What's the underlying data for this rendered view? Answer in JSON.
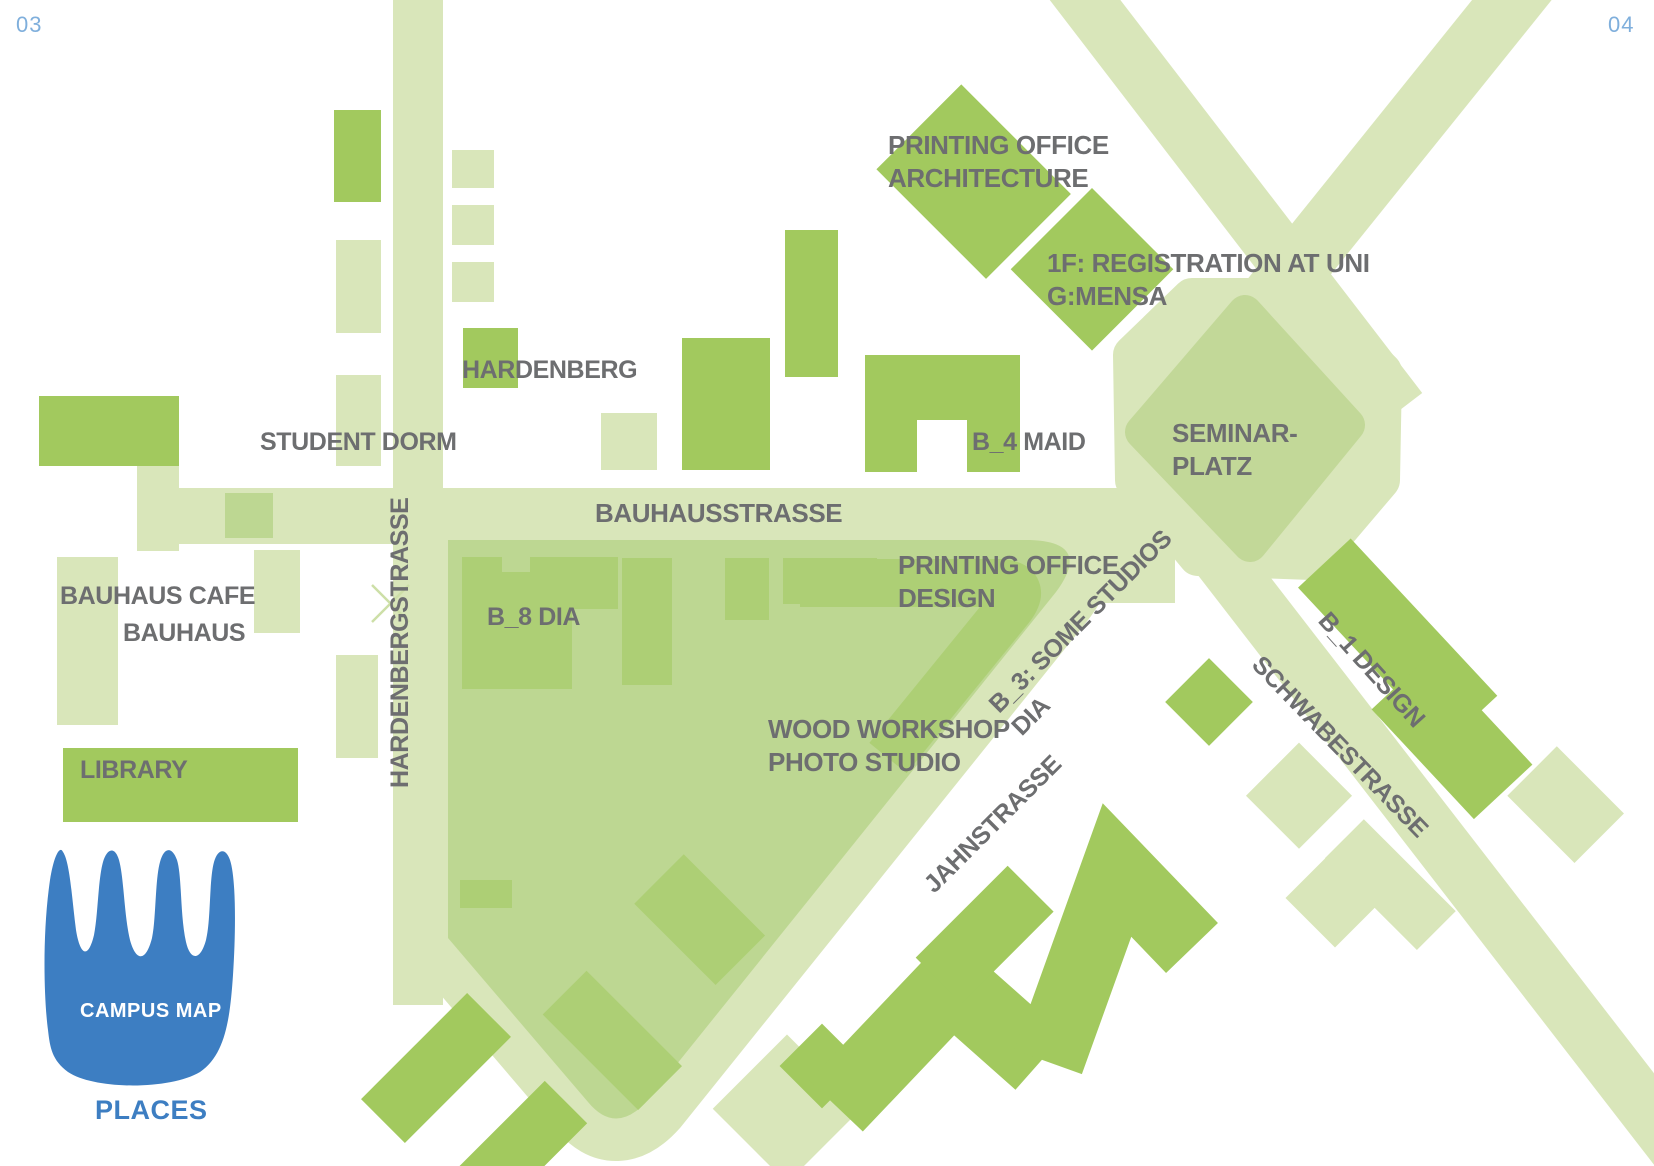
{
  "page": {
    "left_number": "03",
    "right_number": "04"
  },
  "map": {
    "streets": {
      "bauhausstrasse": "BAUHAUSSTRASSE",
      "hardenbergstrasse": "HARDENBERGSTRASSE",
      "jahnstrasse": "JAHNSTRASSE",
      "schwabestrasse": "SCHWABESTRASSE"
    },
    "places": {
      "printing_office_architecture": {
        "line1": "PRINTING OFFICE",
        "line2": "ARCHITECTURE"
      },
      "registration": {
        "line1": "1F: REGISTRATION AT UNI",
        "line2": "G:MENSA"
      },
      "hardenberg": "HARDENBERG",
      "student_dorm": "STUDENT DORM",
      "b4_maid": "B_4 MAID",
      "seminarplatz": {
        "line1": "SEMINAR-",
        "line2": "PLATZ"
      },
      "bauhaus_cafe": "BAUHAUS CAFE",
      "bauhaus": "BAUHAUS",
      "b8_dia": "B_8 DIA",
      "printing_office_design": {
        "line1": "PRINTING OFFICE",
        "line2": "DESIGN"
      },
      "b3_studios": {
        "line1": "B_3: SOME STUDIOS",
        "line2": "DIA"
      },
      "wood_workshop": {
        "line1": "WOOD WORKSHOP",
        "line2": "PHOTO STUDIO"
      },
      "b1_design": "B_1 DESIGN",
      "library": "LIBRARY"
    },
    "legend": {
      "logo_label": "CAMPUS MAP",
      "caption": "PLACES"
    },
    "colors": {
      "street_green": "#d9e6ba",
      "block_green": "#bdd792",
      "building_inner_green": "#adcf75",
      "building_dark_green": "#a2c95e",
      "label_gray": "#6d6e70",
      "accent_blue": "#3d7ec2",
      "page_number_blue": "#7fafdc"
    }
  }
}
